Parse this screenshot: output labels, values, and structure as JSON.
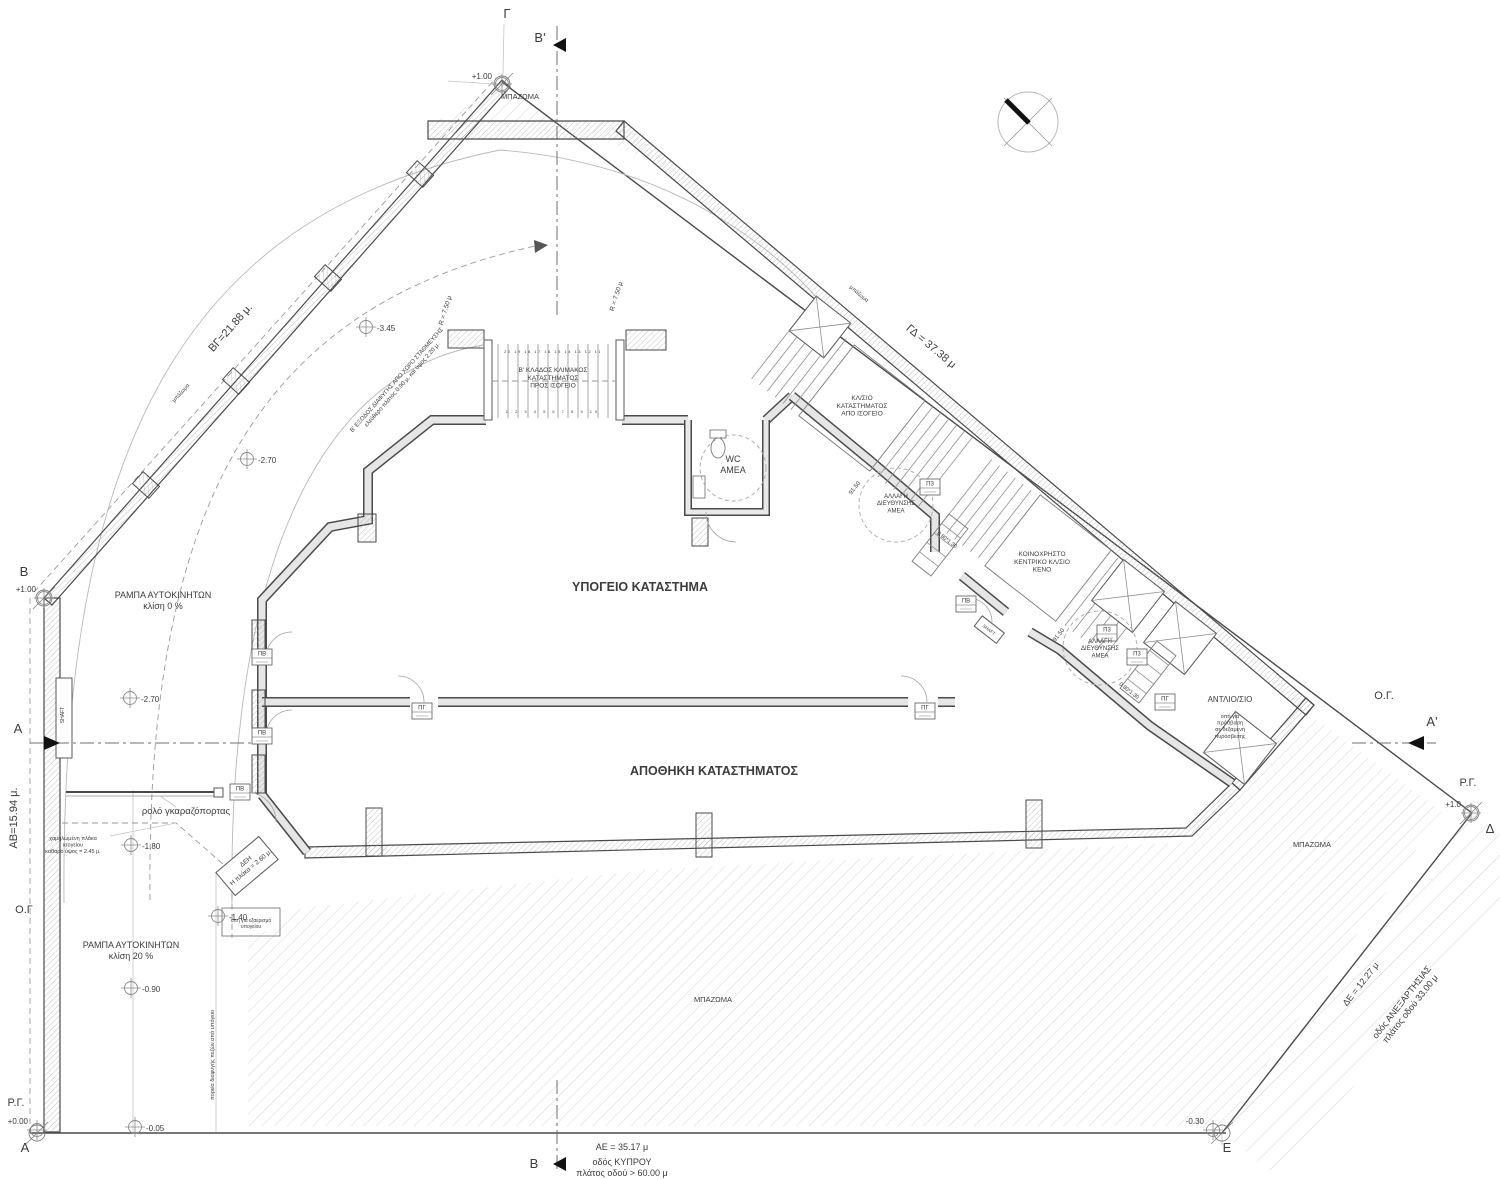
{
  "colors": {
    "text": "#3c3c3c",
    "line_dark": "#4a4a4a",
    "line_light": "#b9b9b9",
    "hatch": "#c9c9c9",
    "wall_fill": "#e6e6e6",
    "marker": "#111111",
    "background": "#ffffff"
  },
  "labels": [
    {
      "name": "area-fill-top",
      "lines": [
        "ΜΠΑΖΩΜΑ"
      ],
      "x": 520,
      "y": 99,
      "size": 7.5
    },
    {
      "name": "area-fill-bottom",
      "lines": [
        "ΜΠΑΖΩΜΑ"
      ],
      "x": 713,
      "y": 1002,
      "size": 7.5
    },
    {
      "name": "area-fill-right",
      "lines": [
        "ΜΠΑΖΩΜΑ"
      ],
      "x": 1312,
      "y": 847,
      "size": 7.5
    },
    {
      "name": "area-fill-small-left",
      "lines": [
        "μπάζωμα"
      ],
      "x": 182,
      "y": 394,
      "size": 5.5,
      "rot": -48
    },
    {
      "name": "area-fill-small-top",
      "lines": [
        "μπάζωμα"
      ],
      "x": 858,
      "y": 295,
      "size": 5.5,
      "rot": 40
    },
    {
      "name": "room-basement-store",
      "lines": [
        "ΥΠΟΓΕΙΟ ΚΑΤΑΣΤΗΜΑ"
      ],
      "x": 640,
      "y": 591,
      "size": 12.5,
      "weight": "700"
    },
    {
      "name": "room-store-storage",
      "lines": [
        "ΑΠΟΘΗΚΗ ΚΑΤΑΣΤΗΜΑΤΟΣ"
      ],
      "x": 714,
      "y": 775,
      "size": 12.5,
      "weight": "700"
    },
    {
      "name": "room-wc-amea",
      "lines": [
        "WC",
        "ΑΜΕΑ"
      ],
      "x": 733,
      "y": 462,
      "size": 9
    },
    {
      "name": "room-pump",
      "lines": [
        "ΑΝΤΛΙΟ/ΣΙΟ"
      ],
      "x": 1230,
      "y": 702,
      "size": 8
    },
    {
      "name": "stair-b-branch",
      "lines": [
        "Β' ΚΛΑΔΟΣ ΚΛΙΜΑΚΟΣ",
        "ΚΑΤΑΣΤΗΜΑΤΟΣ",
        "ΠΡΟΣ ΙΣΟΓΕΙΟ"
      ],
      "x": 553,
      "y": 372,
      "size": 6.5
    },
    {
      "name": "stair-from-ground",
      "lines": [
        "ΚΛ/ΣΙΟ",
        "ΚΑΤΑΣΤΗΜΑΤΟΣ",
        "ΑΠΟ ΙΣΟΓΕΙΟ"
      ],
      "x": 862,
      "y": 400,
      "size": 6.5
    },
    {
      "name": "stair-communal",
      "lines": [
        "ΚΟΙΝΟΧΡΗΣΤΟ",
        "ΚΕΝΤΡΙΚΟ ΚΛ/ΣΙΟ",
        "ΚΕΝΟ"
      ],
      "x": 1042,
      "y": 556,
      "size": 6.5
    },
    {
      "name": "amea-turn-1",
      "lines": [
        "ΑΛΛΑΓΗ",
        "ΔΙΕΥΘΥΝΣΗΣ",
        "ΑΜΕΑ"
      ],
      "x": 896,
      "y": 498,
      "size": 6
    },
    {
      "name": "amea-turn-2",
      "lines": [
        "ΑΛΛΑΓΗ",
        "ΔΙΕΥΘΥΝΣΗΣ",
        "ΑΜΕΑ"
      ],
      "x": 1100,
      "y": 643,
      "size": 6
    },
    {
      "name": "ramp-slope-0",
      "lines": [
        "ΡΑΜΠΑ ΑΥΤΟΚΙΝΗΤΩΝ",
        "κλίση 0 %"
      ],
      "x": 163,
      "y": 598,
      "size": 9
    },
    {
      "name": "ramp-slope-20",
      "lines": [
        "ΡΑΜΠΑ ΑΥΤΟΚΙΝΗΤΩΝ",
        "κλίση 20 %"
      ],
      "x": 131,
      "y": 948,
      "size": 9
    },
    {
      "name": "garage-roller-door",
      "lines": [
        "ρολό γκαραζόπορτας"
      ],
      "x": 186,
      "y": 814,
      "size": 9.5
    },
    {
      "name": "dim-bg",
      "lines": [
        "ΒΓ=21.88 μ."
      ],
      "x": 233,
      "y": 330,
      "size": 11,
      "rot": -48.5
    },
    {
      "name": "dim-gd",
      "lines": [
        "ΓΔ = 37.38 μ"
      ],
      "x": 929,
      "y": 349,
      "size": 11,
      "rot": 40
    },
    {
      "name": "dim-ab",
      "lines": [
        "ΑΒ=15.94 μ."
      ],
      "x": 17,
      "y": 818,
      "size": 11,
      "rot": -90
    },
    {
      "name": "dim-ae",
      "lines": [
        "ΑΕ = 35.17 μ"
      ],
      "x": 622,
      "y": 1150,
      "size": 9
    },
    {
      "name": "road-kyprou",
      "lines": [
        "οδός ΚΥΠΡΟΥ",
        "πλάτος οδού > 60.00 μ"
      ],
      "x": 622,
      "y": 1165,
      "size": 9
    },
    {
      "name": "dim-de",
      "lines": [
        "ΔΕ = 12.27 μ"
      ],
      "x": 1363,
      "y": 986,
      "size": 9,
      "rot": -52
    },
    {
      "name": "road-anexartisias",
      "lines": [
        "οδός ΑΝΕΞΑΡΤΗΣΙΑΣ",
        "πλάτος οδού 33.00 μ"
      ],
      "x": 1404,
      "y": 1004,
      "size": 9,
      "rot": -52
    },
    {
      "name": "building-line-left",
      "lines": [
        "Ο.Γ"
      ],
      "x": 24,
      "y": 913,
      "size": 11
    },
    {
      "name": "building-line-right",
      "lines": [
        "Ο.Γ."
      ],
      "x": 1384,
      "y": 699,
      "size": 11
    },
    {
      "name": "regulation-line-left",
      "lines": [
        "Ρ.Γ."
      ],
      "x": 16,
      "y": 1106,
      "size": 11
    },
    {
      "name": "regulation-line-right",
      "lines": [
        "Ρ.Γ."
      ],
      "x": 1468,
      "y": 786,
      "size": 11
    },
    {
      "name": "note-lowered-slab",
      "lines": [
        "χαμηλωμένη πλάκα",
        "ισογείου",
        "καθαρό ύψος = 2.45 μ."
      ],
      "x": 73,
      "y": 840,
      "size": 5.5
    },
    {
      "name": "note-fire-tank",
      "lines": [
        "οπή για",
        "πρόσβαση",
        "σε δεξαμενή",
        "πυρόσβεσης"
      ],
      "x": 1230,
      "y": 718,
      "size": 5.5
    },
    {
      "name": "note-vent-opening",
      "lines": [
        "οπή για εξαερισμό",
        "υπογείου"
      ],
      "x": 251,
      "y": 922,
      "size": 5
    },
    {
      "name": "note-escape-path",
      "lines": [
        "πορεία διαφυγής πεζών από υπόγειο"
      ],
      "x": 214,
      "y": 1055,
      "size": 5.5,
      "rot": -90
    },
    {
      "name": "note-exit-b",
      "lines": [
        "Β' ΕΞΟΔΟΣ ΔΙΑΦΥΓΗΣ ΑΠΟ ΧΩΡΟ ΣΤΑΘΜΕΥΣΗΣ",
        "ελεύθερο πλάτος 0.90 μ. και ύψος 2.20 μ."
      ],
      "x": 398,
      "y": 381,
      "size": 6,
      "rot": -48.5
    },
    {
      "name": "note-deh",
      "lines": [
        "ΔΕΗ",
        "Η πλάκα = 2.60 μ."
      ],
      "x": 247,
      "y": 863,
      "size": 6.5,
      "rot": -40
    },
    {
      "name": "note-shaft-left",
      "lines": [
        "SHAFT"
      ],
      "x": 64,
      "y": 715,
      "size": 5,
      "rot": -90
    },
    {
      "name": "note-shaft-right",
      "lines": [
        "SHAFT"
      ],
      "x": 988,
      "y": 631,
      "size": 4.5,
      "rot": 38
    },
    {
      "name": "radius-750-1",
      "lines": [
        "R = 7.50 μ"
      ],
      "x": 447,
      "y": 311,
      "size": 6.5,
      "rot": -73
    },
    {
      "name": "radius-750-2",
      "lines": [
        "R = 7.50 μ"
      ],
      "x": 618,
      "y": 297,
      "size": 6.5,
      "rot": -73
    },
    {
      "name": "level-9150-1",
      "lines": [
        "91.50"
      ],
      "x": 856,
      "y": 489,
      "size": 6,
      "rot": -52
    },
    {
      "name": "level-9150-2",
      "lines": [
        "91.50"
      ],
      "x": 1060,
      "y": 636,
      "size": 6,
      "rot": -52
    },
    {
      "name": "dim-platform-1",
      "lines": [
        "0.80*1.30"
      ],
      "x": 946,
      "y": 541,
      "size": 5.5,
      "rot": 38
    },
    {
      "name": "dim-platform-2",
      "lines": [
        "0.80*1.30"
      ],
      "x": 1128,
      "y": 692,
      "size": 5.5,
      "rot": 38
    },
    {
      "name": "treads-upper-numbers",
      "lines": [
        "20 19 18 17 16 15 14 13 12 11"
      ],
      "x": 553,
      "y": 353,
      "size": 4,
      "ls": 1.5
    },
    {
      "name": "treads-lower-numbers",
      "lines": [
        "1 2 3 4 5 6 7 8 9 10"
      ],
      "x": 553,
      "y": 413,
      "size": 4,
      "ls": 3
    }
  ],
  "elevations": [
    {
      "name": "elev-gamma",
      "value": "+1.00",
      "cx": 502,
      "cy": 84,
      "tx": 492,
      "ty": 79,
      "anchor": "end"
    },
    {
      "name": "elev-b",
      "value": "+1.00",
      "cx": 44,
      "cy": 598,
      "tx": 36,
      "ty": 592,
      "anchor": "end"
    },
    {
      "name": "elev-270-a",
      "value": "-2.70",
      "cx": 247,
      "cy": 459,
      "tx": 258,
      "ty": 463,
      "anchor": "start"
    },
    {
      "name": "elev-345",
      "value": "-3.45",
      "cx": 366,
      "cy": 327,
      "tx": 377,
      "ty": 331,
      "anchor": "start"
    },
    {
      "name": "elev-270-b",
      "value": "-2.70",
      "cx": 130,
      "cy": 698,
      "tx": 141,
      "ty": 702,
      "anchor": "start"
    },
    {
      "name": "elev-180",
      "value": "-1.80",
      "cx": 131,
      "cy": 845,
      "tx": 142,
      "ty": 849,
      "anchor": "start"
    },
    {
      "name": "elev-140",
      "value": "-1.40",
      "cx": 218,
      "cy": 916,
      "tx": 229,
      "ty": 920,
      "anchor": "start"
    },
    {
      "name": "elev-090",
      "value": "-0.90",
      "cx": 131,
      "cy": 988,
      "tx": 142,
      "ty": 992,
      "anchor": "start"
    },
    {
      "name": "elev-005",
      "value": "-0.05",
      "cx": 135,
      "cy": 1127,
      "tx": 146,
      "ty": 1131,
      "anchor": "start"
    },
    {
      "name": "elev-000",
      "value": "+0.00",
      "cx": 37,
      "cy": 1130,
      "tx": 28,
      "ty": 1124,
      "anchor": "end"
    },
    {
      "name": "elev-030",
      "value": "-0.30",
      "cx": 1213,
      "cy": 1130,
      "tx": 1204,
      "ty": 1124,
      "anchor": "end"
    },
    {
      "name": "elev-delta",
      "value": "+1.0",
      "cx": 1471,
      "cy": 813,
      "tx": 1461,
      "ty": 807,
      "anchor": "end"
    }
  ],
  "survey_points": [
    {
      "name": "point-gamma",
      "label": "Γ",
      "cx": 502,
      "cy": 84,
      "lx": 507,
      "ly": 18,
      "lsize": 13
    },
    {
      "name": "point-b",
      "label": "Β",
      "cx": 44,
      "cy": 598,
      "lx": 24,
      "ly": 576,
      "lsize": 13
    },
    {
      "name": "point-a",
      "label": "Α",
      "cx": 37,
      "cy": 1133,
      "lx": 25,
      "ly": 1152,
      "lsize": 13
    },
    {
      "name": "point-delta",
      "label": "Δ",
      "cx": 1471,
      "cy": 813,
      "lx": 1490,
      "ly": 833,
      "lsize": 13
    },
    {
      "name": "point-e",
      "label": "Ε",
      "cx": 1222,
      "cy": 1133,
      "lx": 1227,
      "ly": 1152,
      "lsize": 13
    }
  ],
  "section_markers": [
    {
      "name": "section-a-left",
      "label": "Α",
      "lx": 18,
      "ly": 733,
      "tri": "44,736 60,743 44,750",
      "line": [
        30,
        743,
        252,
        743
      ]
    },
    {
      "name": "section-a-right",
      "label": "Α'",
      "lx": 1432,
      "ly": 726,
      "tri": "1424,736 1408,743 1424,750",
      "line": [
        1352,
        743,
        1436,
        743
      ]
    },
    {
      "name": "section-b-top",
      "label": "Β'",
      "lx": 540,
      "ly": 42,
      "tri": "566,38 553,45 566,52",
      "line": [
        557,
        26,
        557,
        318
      ]
    },
    {
      "name": "section-b-bottom",
      "label": "Β",
      "lx": 534,
      "ly": 1168,
      "tri": "566,1157 553,1164 566,1171",
      "line": [
        557,
        1080,
        557,
        1172
      ]
    }
  ],
  "door_tags": [
    {
      "name": "tag-pb-1",
      "label": "ΠΒ",
      "x": 262,
      "y": 657
    },
    {
      "name": "tag-pb-2",
      "label": "ΠΒ",
      "x": 262,
      "y": 736
    },
    {
      "name": "tag-pb-3",
      "label": "ΠΒ",
      "x": 240,
      "y": 792
    },
    {
      "name": "tag-pg-1",
      "label": "ΠΓ",
      "x": 422,
      "y": 711
    },
    {
      "name": "tag-pg-2",
      "label": "ΠΓ",
      "x": 925,
      "y": 711
    },
    {
      "name": "tag-p3-1",
      "label": "Π3",
      "x": 930,
      "y": 487
    },
    {
      "name": "tag-pb-4",
      "label": "ΠΒ",
      "x": 966,
      "y": 604
    },
    {
      "name": "tag-p3-2",
      "label": "Π3",
      "x": 1107,
      "y": 633
    },
    {
      "name": "tag-p3-3",
      "label": "Π3",
      "x": 1137,
      "y": 657
    },
    {
      "name": "tag-pg-3",
      "label": "ΠΓ",
      "x": 1165,
      "y": 702
    }
  ],
  "north_arrow": {
    "name": "north-arrow",
    "cx": 1028,
    "cy": 122,
    "r": 30
  }
}
